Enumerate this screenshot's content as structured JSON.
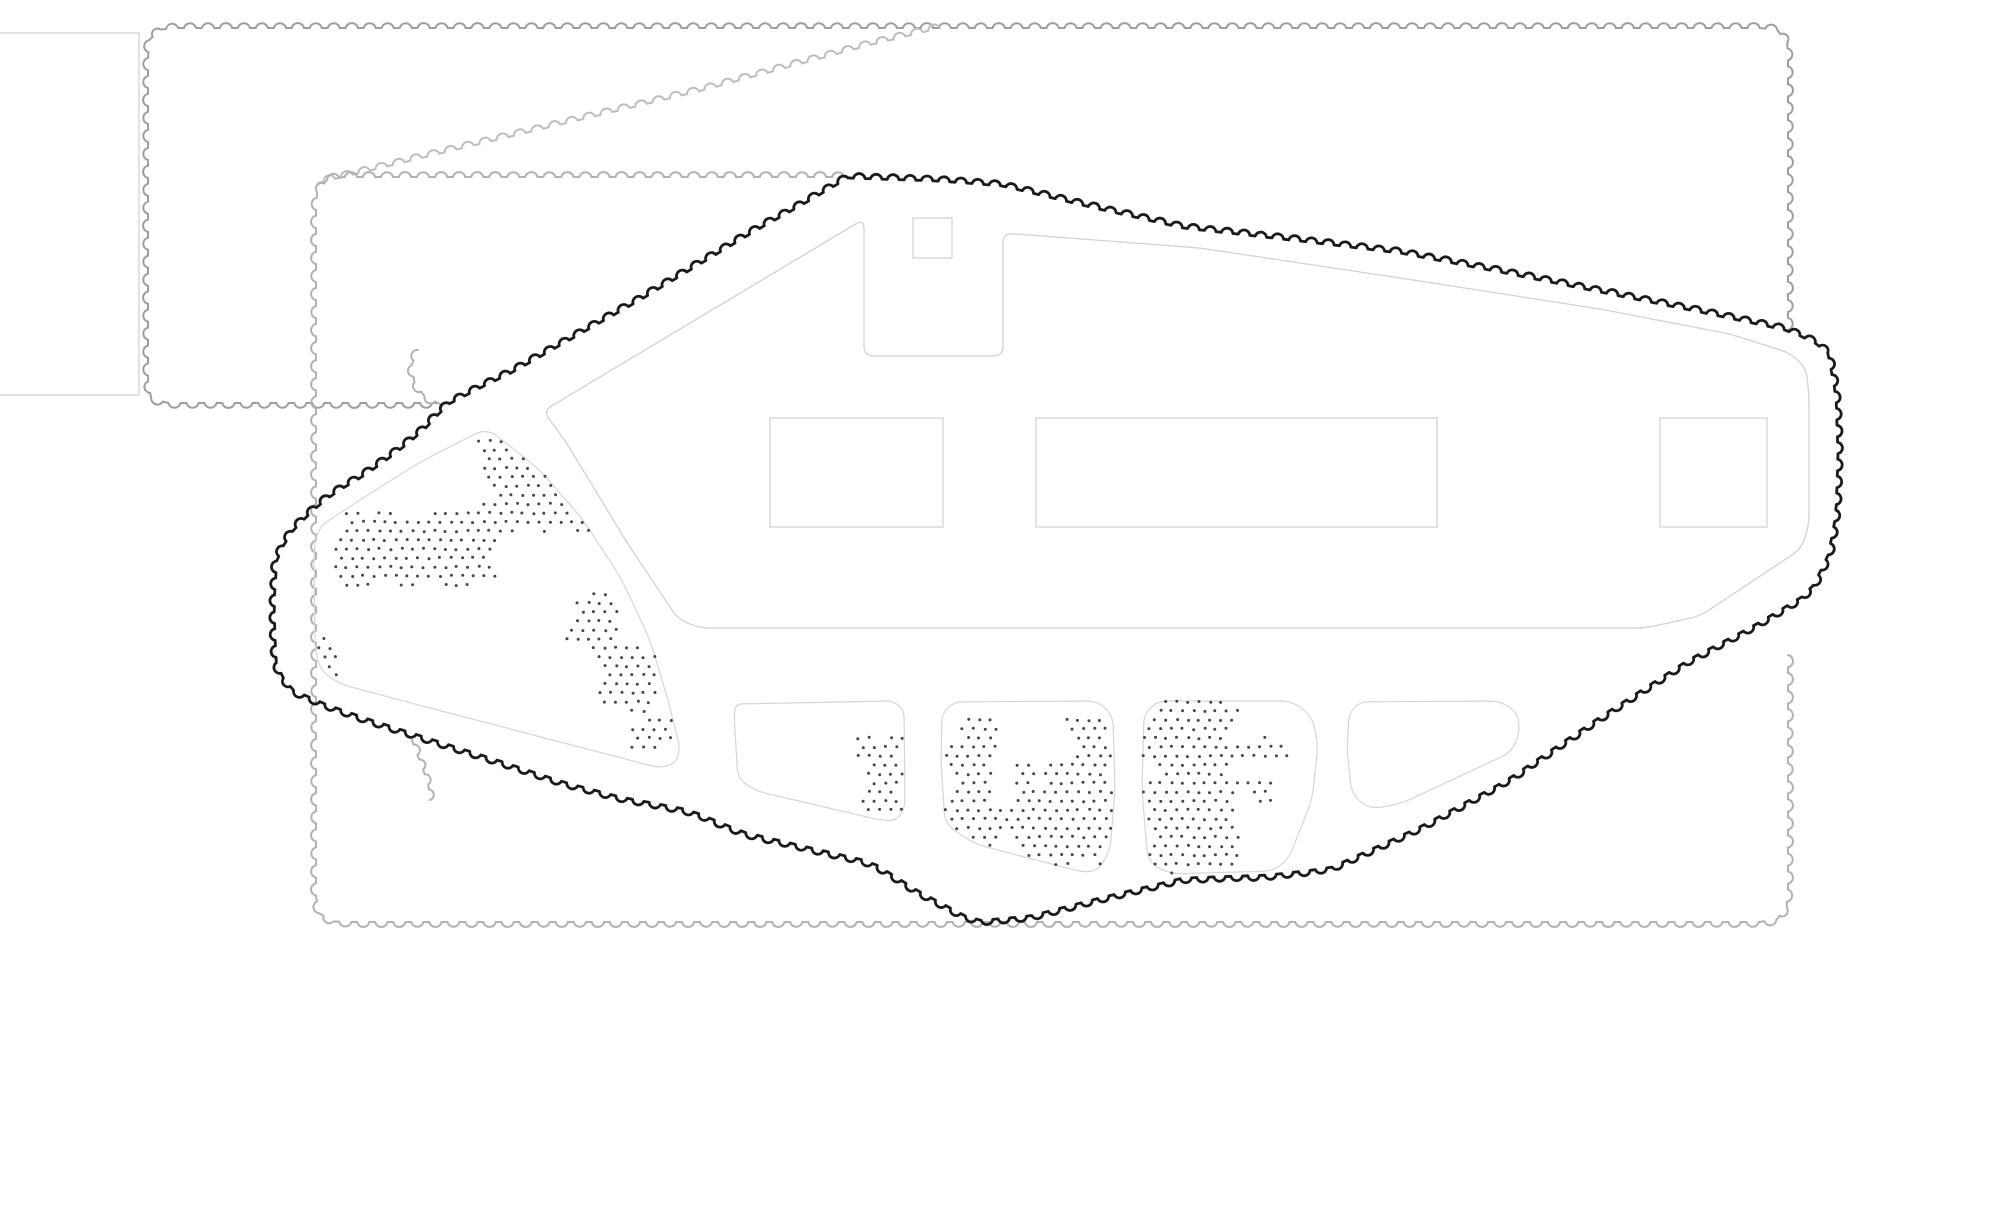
{
  "colors": {
    "background": "#ffffff",
    "boundary": "#1a1a1a",
    "hedge_dark": "#9e9e9e",
    "hedge_mid": "#b2b2b2",
    "hedge_light": "#bdbdbd",
    "outline": "#d2d2d2",
    "grove_fill": "#f1f1f1",
    "grove_stroke": "#d6d6d6",
    "dot": "#454545"
  },
  "strokes": {
    "boundary_width": 2.8,
    "hedge_width": 2.0,
    "outline_width": 1.3,
    "grove_width": 1.2
  },
  "scallop": {
    "hedge_wavelength": 18,
    "boundary_wavelength": 17
  },
  "frame_rect": {
    "x": -6,
    "y": 33,
    "w": 145,
    "h": 362
  },
  "hedges": [
    {
      "name": "hedge-upper-field",
      "color": "#9e9e9e",
      "sweep": 1,
      "closed": false,
      "points": [
        [
          438,
          403
        ],
        [
          166,
          403
        ],
        [
          150,
          398
        ],
        [
          148,
          385
        ],
        [
          148,
          45
        ],
        [
          151,
          32
        ],
        [
          166,
          28
        ],
        [
          1770,
          28
        ],
        [
          1784,
          32
        ],
        [
          1788,
          45
        ],
        [
          1788,
          330
        ]
      ]
    },
    {
      "name": "hedge-diagonal",
      "color": "#bdbdbd",
      "sweep": 1,
      "closed": false,
      "points": [
        [
          318,
          183
        ],
        [
          500,
          139
        ],
        [
          700,
          91
        ],
        [
          870,
          45
        ],
        [
          940,
          28
        ]
      ]
    },
    {
      "name": "hedge-lower-field",
      "color": "#b2b2b2",
      "sweep": 0,
      "closed": false,
      "points": [
        [
          850,
          177
        ],
        [
          335,
          177
        ],
        [
          320,
          182
        ],
        [
          316,
          196
        ],
        [
          316,
          903
        ],
        [
          320,
          917
        ],
        [
          335,
          922
        ],
        [
          1770,
          922
        ],
        [
          1784,
          917
        ],
        [
          1788,
          903
        ],
        [
          1788,
          655
        ]
      ]
    },
    {
      "name": "hedge-stub-upper",
      "color": "#b2b2b2",
      "sweep": 1,
      "closed": false,
      "points": [
        [
          440,
          404
        ],
        [
          424,
          396
        ],
        [
          413,
          380
        ],
        [
          411,
          362
        ],
        [
          418,
          350
        ]
      ]
    },
    {
      "name": "hedge-stub-lower",
      "color": "#b2b2b2",
      "sweep": 1,
      "closed": false,
      "points": [
        [
          412,
          740
        ],
        [
          420,
          762
        ],
        [
          428,
          782
        ],
        [
          430,
          800
        ]
      ]
    }
  ],
  "boundary": {
    "color": "#1a1a1a",
    "sweep": 1,
    "closed": true,
    "points": [
      [
        848,
        178
      ],
      [
        940,
        181
      ],
      [
        1003,
        186
      ],
      [
        1090,
        207
      ],
      [
        1183,
        228
      ],
      [
        1300,
        241
      ],
      [
        1400,
        253
      ],
      [
        1500,
        272
      ],
      [
        1600,
        292
      ],
      [
        1700,
        312
      ],
      [
        1790,
        331
      ],
      [
        1827,
        349
      ],
      [
        1836,
        395
      ],
      [
        1838,
        455
      ],
      [
        1836,
        515
      ],
      [
        1828,
        556
      ],
      [
        1810,
        592
      ],
      [
        1755,
        625
      ],
      [
        1690,
        659
      ],
      [
        1600,
        717
      ],
      [
        1507,
        780
      ],
      [
        1420,
        827
      ],
      [
        1330,
        868
      ],
      [
        1270,
        875
      ],
      [
        1183,
        878
      ],
      [
        1100,
        898
      ],
      [
        1030,
        916
      ],
      [
        975,
        921
      ],
      [
        920,
        892
      ],
      [
        872,
        862
      ],
      [
        807,
        847
      ],
      [
        743,
        832
      ],
      [
        690,
        810
      ],
      [
        620,
        797
      ],
      [
        560,
        781
      ],
      [
        500,
        761
      ],
      [
        440,
        742
      ],
      [
        380,
        723
      ],
      [
        330,
        706
      ],
      [
        288,
        688
      ],
      [
        276,
        662
      ],
      [
        274,
        605
      ],
      [
        277,
        556
      ],
      [
        292,
        532
      ],
      [
        312,
        511
      ],
      [
        336,
        492
      ],
      [
        362,
        477
      ],
      [
        392,
        456
      ],
      [
        422,
        432
      ],
      [
        447,
        405
      ],
      [
        480,
        388
      ],
      [
        513,
        372
      ],
      [
        550,
        351
      ],
      [
        587,
        330
      ],
      [
        640,
        300
      ],
      [
        700,
        264
      ],
      [
        755,
        231
      ],
      [
        800,
        206
      ]
    ]
  },
  "building": {
    "corner_radius": 10,
    "outline": [
      [
        543,
        411
      ],
      [
        864,
        219
      ],
      [
        864,
        356
      ],
      [
        1003,
        356
      ],
      [
        1003,
        233
      ],
      [
        1200,
        248
      ],
      [
        1400,
        278
      ],
      [
        1600,
        309
      ],
      [
        1730,
        334
      ],
      [
        1790,
        353
      ],
      [
        1806,
        368
      ],
      [
        1809,
        395
      ],
      [
        1809,
        525
      ],
      [
        1801,
        549
      ],
      [
        1700,
        616
      ],
      [
        1645,
        628
      ],
      [
        700,
        628
      ],
      [
        678,
        619
      ],
      [
        628,
        544
      ],
      [
        564,
        439
      ]
    ],
    "courtyards": [
      {
        "x": 770,
        "y": 418,
        "w": 173,
        "h": 109
      },
      {
        "x": 1036,
        "y": 418,
        "w": 401,
        "h": 109
      },
      {
        "x": 1660,
        "y": 418,
        "w": 107,
        "h": 109
      }
    ],
    "niche_square": {
      "x": 913,
      "y": 218,
      "w": 39,
      "h": 40
    }
  },
  "groves": [
    {
      "name": "grove-west-triangle",
      "radius": 14,
      "seed": 7,
      "outline": [
        [
          487,
          428
        ],
        [
          540,
          470
        ],
        [
          584,
          521
        ],
        [
          622,
          580
        ],
        [
          650,
          640
        ],
        [
          668,
          700
        ],
        [
          680,
          748
        ],
        [
          676,
          763
        ],
        [
          660,
          768
        ],
        [
          560,
          742
        ],
        [
          430,
          708
        ],
        [
          340,
          684
        ],
        [
          321,
          671
        ],
        [
          315,
          650
        ],
        [
          314,
          545
        ],
        [
          320,
          526
        ],
        [
          360,
          500
        ],
        [
          420,
          462
        ]
      ],
      "clumps": [
        [
          478,
          430,
          662,
          540,
          0.95
        ],
        [
          330,
          505,
          502,
          592,
          0.92
        ],
        [
          292,
          628,
          352,
          702,
          0.85
        ],
        [
          563,
          593,
          629,
          659,
          0.82
        ],
        [
          592,
          648,
          659,
          713,
          0.82
        ],
        [
          620,
          700,
          676,
          764,
          0.82
        ]
      ]
    },
    {
      "name": "grove-south-1",
      "radius": 12,
      "seed": 11,
      "outline": [
        [
          736,
          704
        ],
        [
          893,
          701
        ],
        [
          904,
          710
        ],
        [
          905,
          808
        ],
        [
          896,
          821
        ],
        [
          880,
          820
        ],
        [
          756,
          791
        ],
        [
          738,
          779
        ],
        [
          734,
          716
        ]
      ],
      "clumps": [
        [
          852,
          736,
          908,
          826,
          0.9
        ]
      ]
    },
    {
      "name": "grove-south-2",
      "radius": 12,
      "seed": 23,
      "outline": [
        [
          942,
          714
        ],
        [
          954,
          702
        ],
        [
          1098,
          701
        ],
        [
          1113,
          716
        ],
        [
          1115,
          790
        ],
        [
          1110,
          852
        ],
        [
          1097,
          871
        ],
        [
          1082,
          872
        ],
        [
          975,
          844
        ],
        [
          945,
          824
        ],
        [
          941,
          760
        ]
      ],
      "clumps": [
        [
          942,
          712,
          1006,
          866,
          0.95
        ],
        [
          1004,
          752,
          1116,
          868,
          0.95
        ],
        [
          1058,
          712,
          1116,
          754,
          0.8
        ]
      ]
    },
    {
      "name": "grove-south-3",
      "radius": 12,
      "seed": 37,
      "outline": [
        [
          1144,
          714
        ],
        [
          1158,
          701
        ],
        [
          1292,
          701
        ],
        [
          1312,
          716
        ],
        [
          1318,
          745
        ],
        [
          1312,
          800
        ],
        [
          1288,
          860
        ],
        [
          1272,
          871
        ],
        [
          1170,
          874
        ],
        [
          1148,
          862
        ],
        [
          1142,
          790
        ]
      ],
      "clumps": [
        [
          1142,
          700,
          1242,
          874,
          0.95
        ],
        [
          1240,
          726,
          1292,
          822,
          0.55
        ]
      ]
    },
    {
      "name": "grove-south-4",
      "radius": 12,
      "seed": 51,
      "outline": [
        [
          1349,
          713
        ],
        [
          1360,
          702
        ],
        [
          1500,
          701
        ],
        [
          1517,
          712
        ],
        [
          1520,
          730
        ],
        [
          1512,
          752
        ],
        [
          1400,
          804
        ],
        [
          1370,
          809
        ],
        [
          1352,
          795
        ],
        [
          1347,
          750
        ]
      ],
      "clumps": []
    }
  ],
  "stipple": {
    "col_step": 11,
    "row_step": 9,
    "offset": 5.5,
    "dot_radius": 1.5,
    "color": "#454545"
  }
}
